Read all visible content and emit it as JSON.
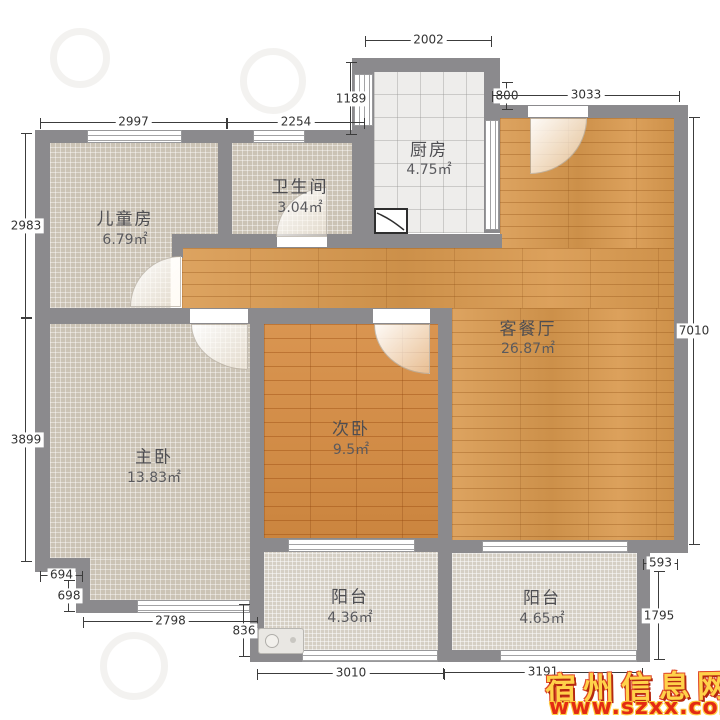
{
  "rooms": {
    "children": {
      "name": "儿童房",
      "area": "6.79㎡"
    },
    "bathroom": {
      "name": "卫生间",
      "area": "3.04㎡"
    },
    "kitchen": {
      "name": "厨房",
      "area": "4.75㎡"
    },
    "living": {
      "name": "客餐厅",
      "area": "26.87㎡"
    },
    "master": {
      "name": "主卧",
      "area": "13.83㎡"
    },
    "second": {
      "name": "次卧",
      "area": "9.5㎡"
    },
    "balcony_left": {
      "name": "阳台",
      "area": "4.36㎡"
    },
    "balcony_right": {
      "name": "阳台",
      "area": "4.65㎡"
    }
  },
  "dims": {
    "children_top": "2997",
    "bath_top": "2254",
    "kitchen_top": "2002",
    "kitchen_side": "1189",
    "kitchen_offset": "800",
    "living_top": "3033",
    "left_upper": "2983",
    "left_lower": "3899",
    "right_side": "7010",
    "notch_w": "694",
    "notch_h": "698",
    "master_bottom": "2798",
    "balcony_gap": "836",
    "balcony_left_bottom": "3010",
    "balcony_right_bottom": "3191",
    "balcony_right_offset": "593",
    "balcony_right_side": "1795"
  },
  "watermark": {
    "site_name": "宿州信息网",
    "site_url": "www.szxx.com.cn"
  },
  "colors": {
    "wall": "#8b8a8d",
    "wood_living": "#d9994e",
    "wood_bedroom": "#d68c42",
    "tile_room": "#cbc3b5",
    "tile_balcony": "#d5cfc4",
    "tile_kitchen": "#eeedeb",
    "dim_line": "#3c3c3c",
    "watermark_yellow": "#ffd24a",
    "watermark_red": "#e32b13"
  }
}
